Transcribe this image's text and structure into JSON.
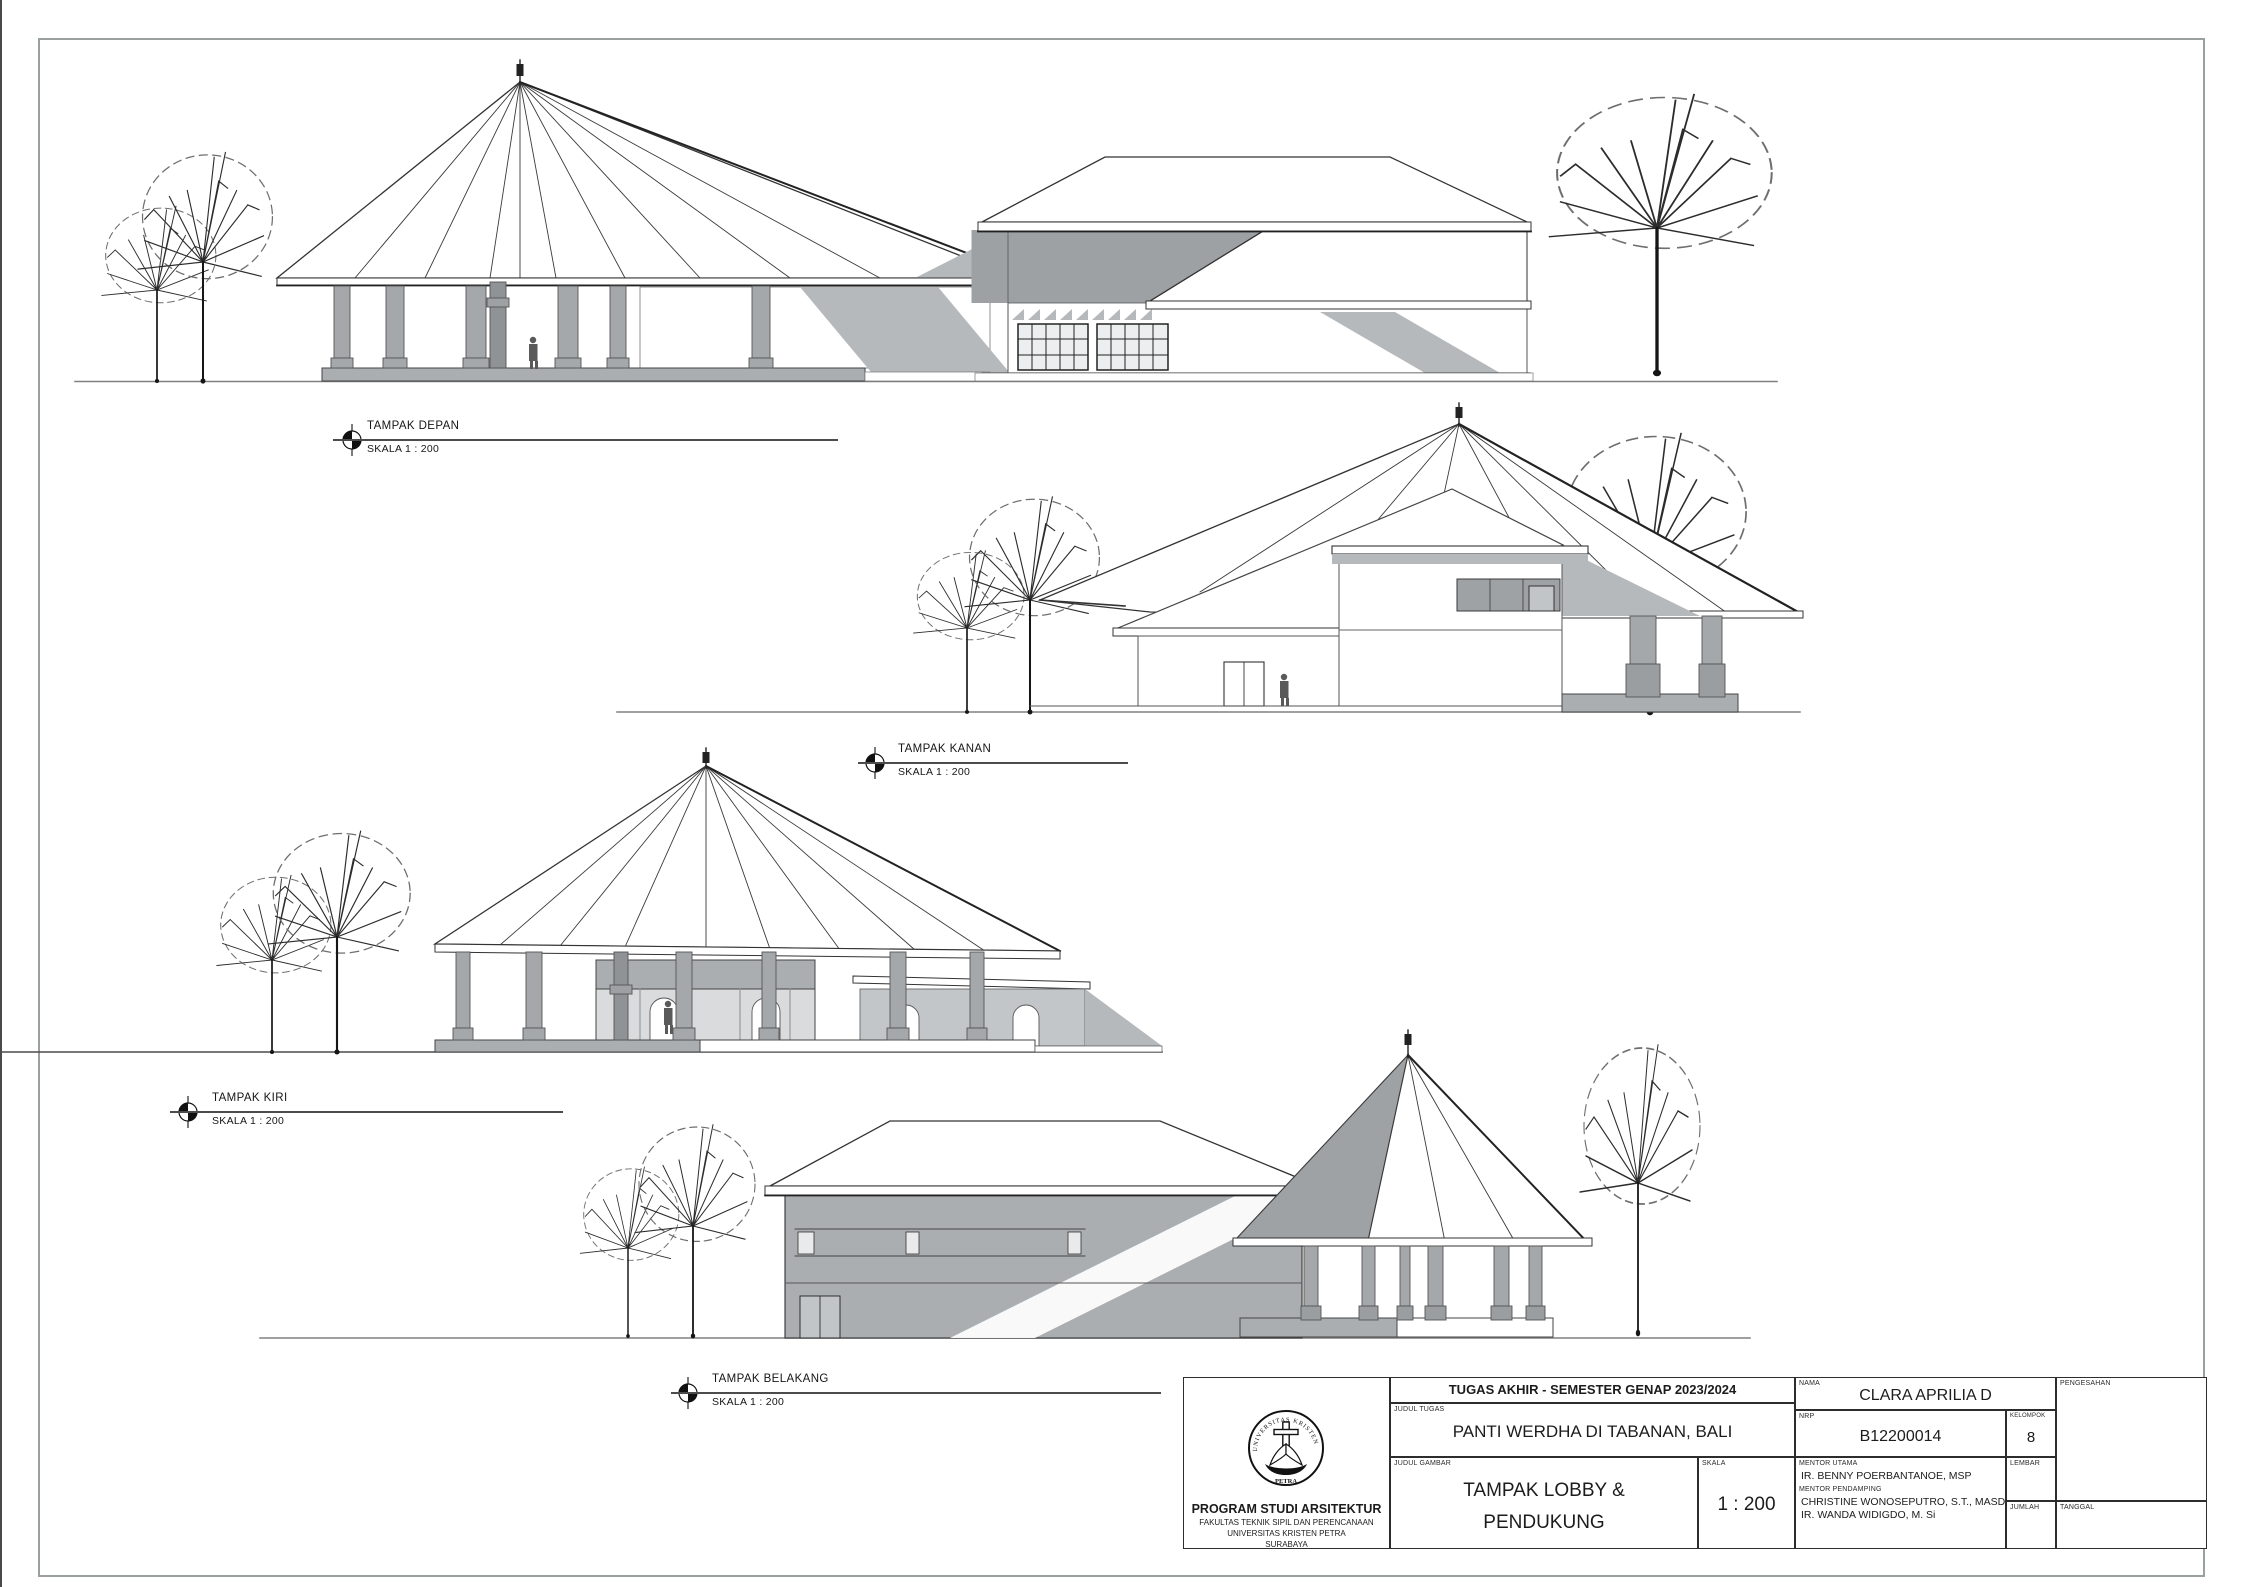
{
  "page": {
    "type": "architectural elevation sheet"
  },
  "colors": {
    "paper": "#ffffff",
    "line": "#3a3a3a",
    "ground_line": "#808080",
    "column_gray": "#a4a8ab",
    "shadow_gray": "#b5b9bb",
    "wall_gray": "#abaeb1",
    "glass_gray": "#d9dbdc",
    "louver_gray": "#9da1a4",
    "border_gray": "#9aa0a0"
  },
  "elevations": [
    {
      "title": "TAMPAK DEPAN",
      "scale": "SKALA 1 : 200"
    },
    {
      "title": "TAMPAK KANAN",
      "scale": "SKALA 1 : 200"
    },
    {
      "title": "TAMPAK KIRI",
      "scale": "SKALA 1 : 200"
    },
    {
      "title": "TAMPAK BELAKANG",
      "scale": "SKALA 1 : 200"
    }
  ],
  "title_block": {
    "header": "TUGAS AKHIR - SEMESTER GENAP 2023/2024",
    "judul_tugas_label": "JUDUL TUGAS",
    "judul_tugas": "PANTI WERDHA DI TABANAN, BALI",
    "judul_gambar_label": "JUDUL GAMBAR",
    "judul_gambar_line1": "TAMPAK LOBBY &",
    "judul_gambar_line2": "PENDUKUNG",
    "skala_label": "SKALA",
    "skala": "1 : 200",
    "nama_label": "NAMA",
    "nama": "CLARA APRILIA D",
    "nrp_label": "NRP",
    "nrp": "B12200014",
    "kelompok_label": "KELOMPOK",
    "kelompok": "8",
    "mentor_utama_label": "MENTOR UTAMA",
    "mentor_utama": "IR. BENNY POERBANTANOE, MSP",
    "mentor_pendamping_label": "MENTOR PENDAMPING",
    "mentor_pendamping_1": "CHRISTINE WONOSEPUTRO, S.T., MASD",
    "mentor_pendamping_2": "IR. WANDA WIDIGDO, M. Si",
    "lembar_label": "LEMBAR",
    "jumlah_label": "JUMLAH",
    "pengesahan_label": "PENGESAHAN",
    "tanggal_label": "TANGGAL",
    "logo_text_top": "UNIVERSITAS KRISTEN",
    "logo_text_bottom": "PETRA",
    "institution_line1": "PROGRAM STUDI ARSITEKTUR",
    "institution_line2": "FAKULTAS TEKNIK SIPIL DAN PERENCANAAN",
    "institution_line3": "UNIVERSITAS KRISTEN PETRA",
    "institution_line4": "SURABAYA"
  }
}
